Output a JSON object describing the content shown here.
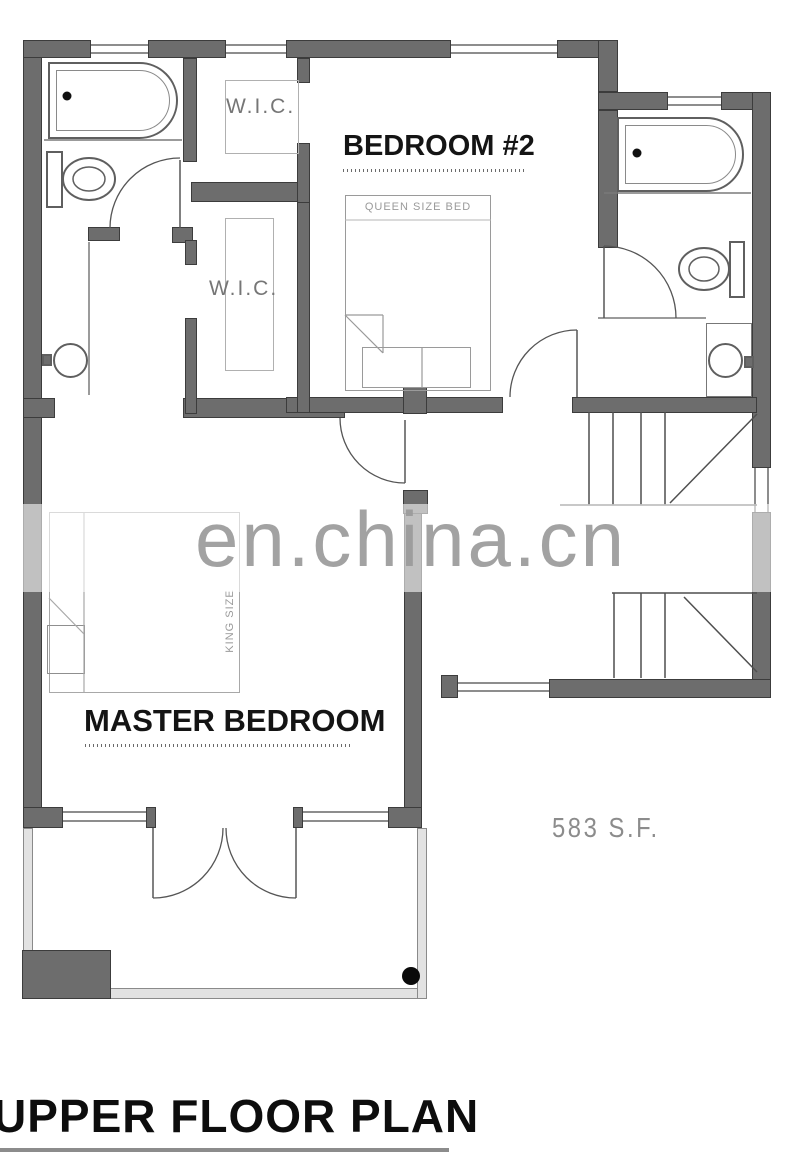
{
  "plan": {
    "title": "UPPER FLOOR PLAN",
    "area_label": "583 S.F.",
    "watermark": "en.china.cn",
    "rooms": {
      "bedroom2": "BEDROOM #2",
      "master_bedroom": "MASTER BEDROOM",
      "wic_upper": "W.I.C.",
      "wic_lower": "W.I.C."
    },
    "furniture": {
      "queen_bed": "QUEEN SIZE BED",
      "king_bed": "KING SIZE"
    },
    "colors": {
      "wall_fill": "#6d6d6d",
      "wall_edge": "#3c3c3c",
      "fixture_line": "#5f5f5f",
      "light_line": "#b0b0b0",
      "label_dark": "#141414",
      "label_gray": "#8c8c8c",
      "watermark_gray": "#9b9b9b",
      "background": "#ffffff"
    }
  }
}
